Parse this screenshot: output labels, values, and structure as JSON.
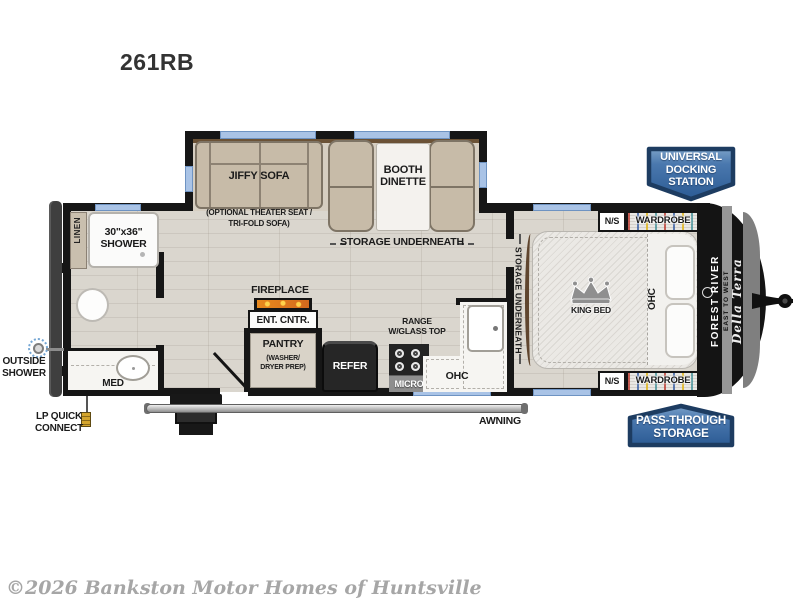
{
  "title": "261RB",
  "watermark": "©2026 Bankston Motor Homes of Huntsville",
  "badges": {
    "docking": [
      "UNIVERSAL",
      "DOCKING",
      "STATION"
    ],
    "passthrough": [
      "PASS-THROUGH",
      "STORAGE"
    ]
  },
  "exterior": {
    "outside_shower": [
      "OUTSIDE",
      "SHOWER"
    ],
    "lp_quick_connect": [
      "LP QUICK",
      "CONNECT"
    ],
    "awning": "AWNING"
  },
  "living": {
    "sofa": "JIFFY SOFA",
    "sofa_option": [
      "(OPTIONAL THEATER SEAT /",
      "TRI-FOLD SOFA)"
    ],
    "dinette": [
      "BOOTH",
      "DINETTE"
    ],
    "dinette_storage": "STORAGE UNDERNEATH",
    "fireplace": "FIREPLACE",
    "ent_center": "ENT. CNTR.",
    "pantry": "PANTRY",
    "pantry_note": [
      "(WASHER/",
      "DRYER PREP)"
    ]
  },
  "bath": {
    "linen": "LINEN",
    "shower": [
      "30\"x36\"",
      "SHOWER"
    ],
    "med": "MED"
  },
  "kitchen": {
    "refer": "REFER",
    "micro": "MICRO",
    "range": [
      "RANGE",
      "W/GLASS TOP"
    ],
    "ohc": "OHC"
  },
  "bedroom": {
    "storage": "STORAGE UNDERNEATH",
    "king_bed": "KING BED",
    "ohc": "OHC",
    "nightstand": "N/S",
    "wardrobe": "WARDROBE"
  },
  "brand": {
    "make": "FOREST RIVER",
    "series": "EAST TO WEST",
    "model": "Della Terra"
  },
  "colors": {
    "badge_blue": "#3f6ca6",
    "badge_border": "#1d3c61",
    "window_blue": "#a9c3e6",
    "wall_black": "#161616",
    "floor_wood": "#d8d4cc",
    "furniture_tan": "#c7bba8"
  }
}
